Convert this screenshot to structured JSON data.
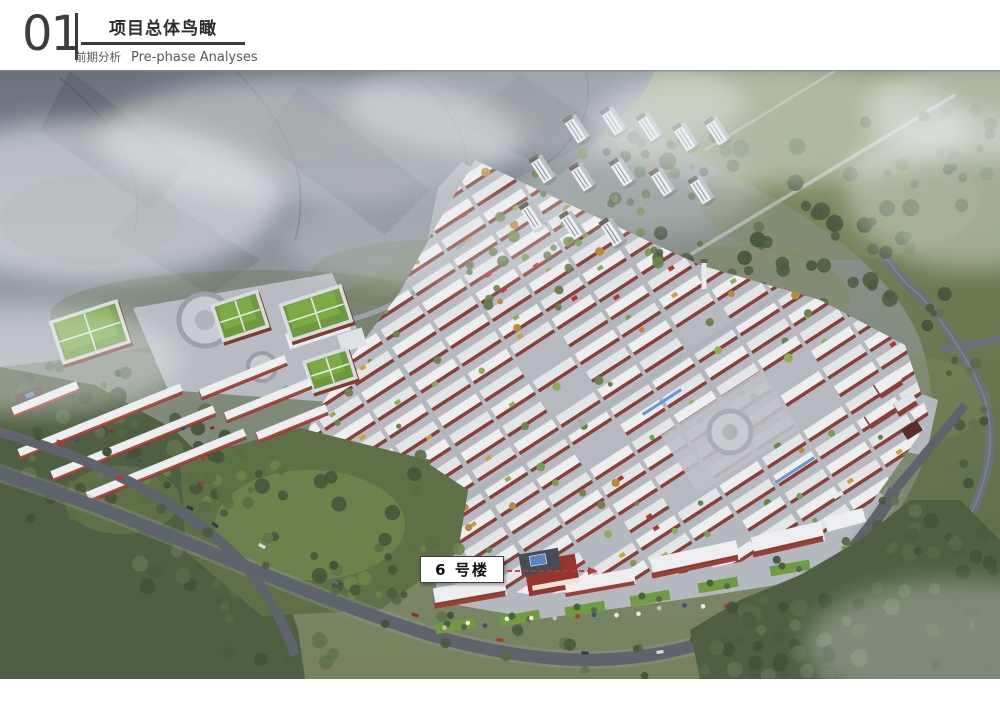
{
  "header": {
    "section_number": "01",
    "title": "项目总体鸟瞰",
    "subtitle_cn": "前期分析",
    "subtitle_en": "Pre-phase Analyses"
  },
  "annotation": {
    "building_label": "6 号楼"
  },
  "palette": {
    "header_text": "#3a3a3c",
    "mountain_dark": "#525a64",
    "mountain_base": "#6a727c",
    "mist": "#eef1f4",
    "field_green": "#76855c",
    "forest_green": "#4e5f42",
    "park_green": "#5d7046",
    "lawn_green": "#6f9c40",
    "town_ground": "#b6bac0",
    "road": "#5f636b",
    "roof_white": "#eceef0",
    "wall_red": "#8a4038",
    "building6_red": "#97362c",
    "green_roof": "#6e9a3d",
    "water_blue": "#5b84c2",
    "tower_cap": "#4c433a",
    "arrow_red": "#c0392b"
  }
}
